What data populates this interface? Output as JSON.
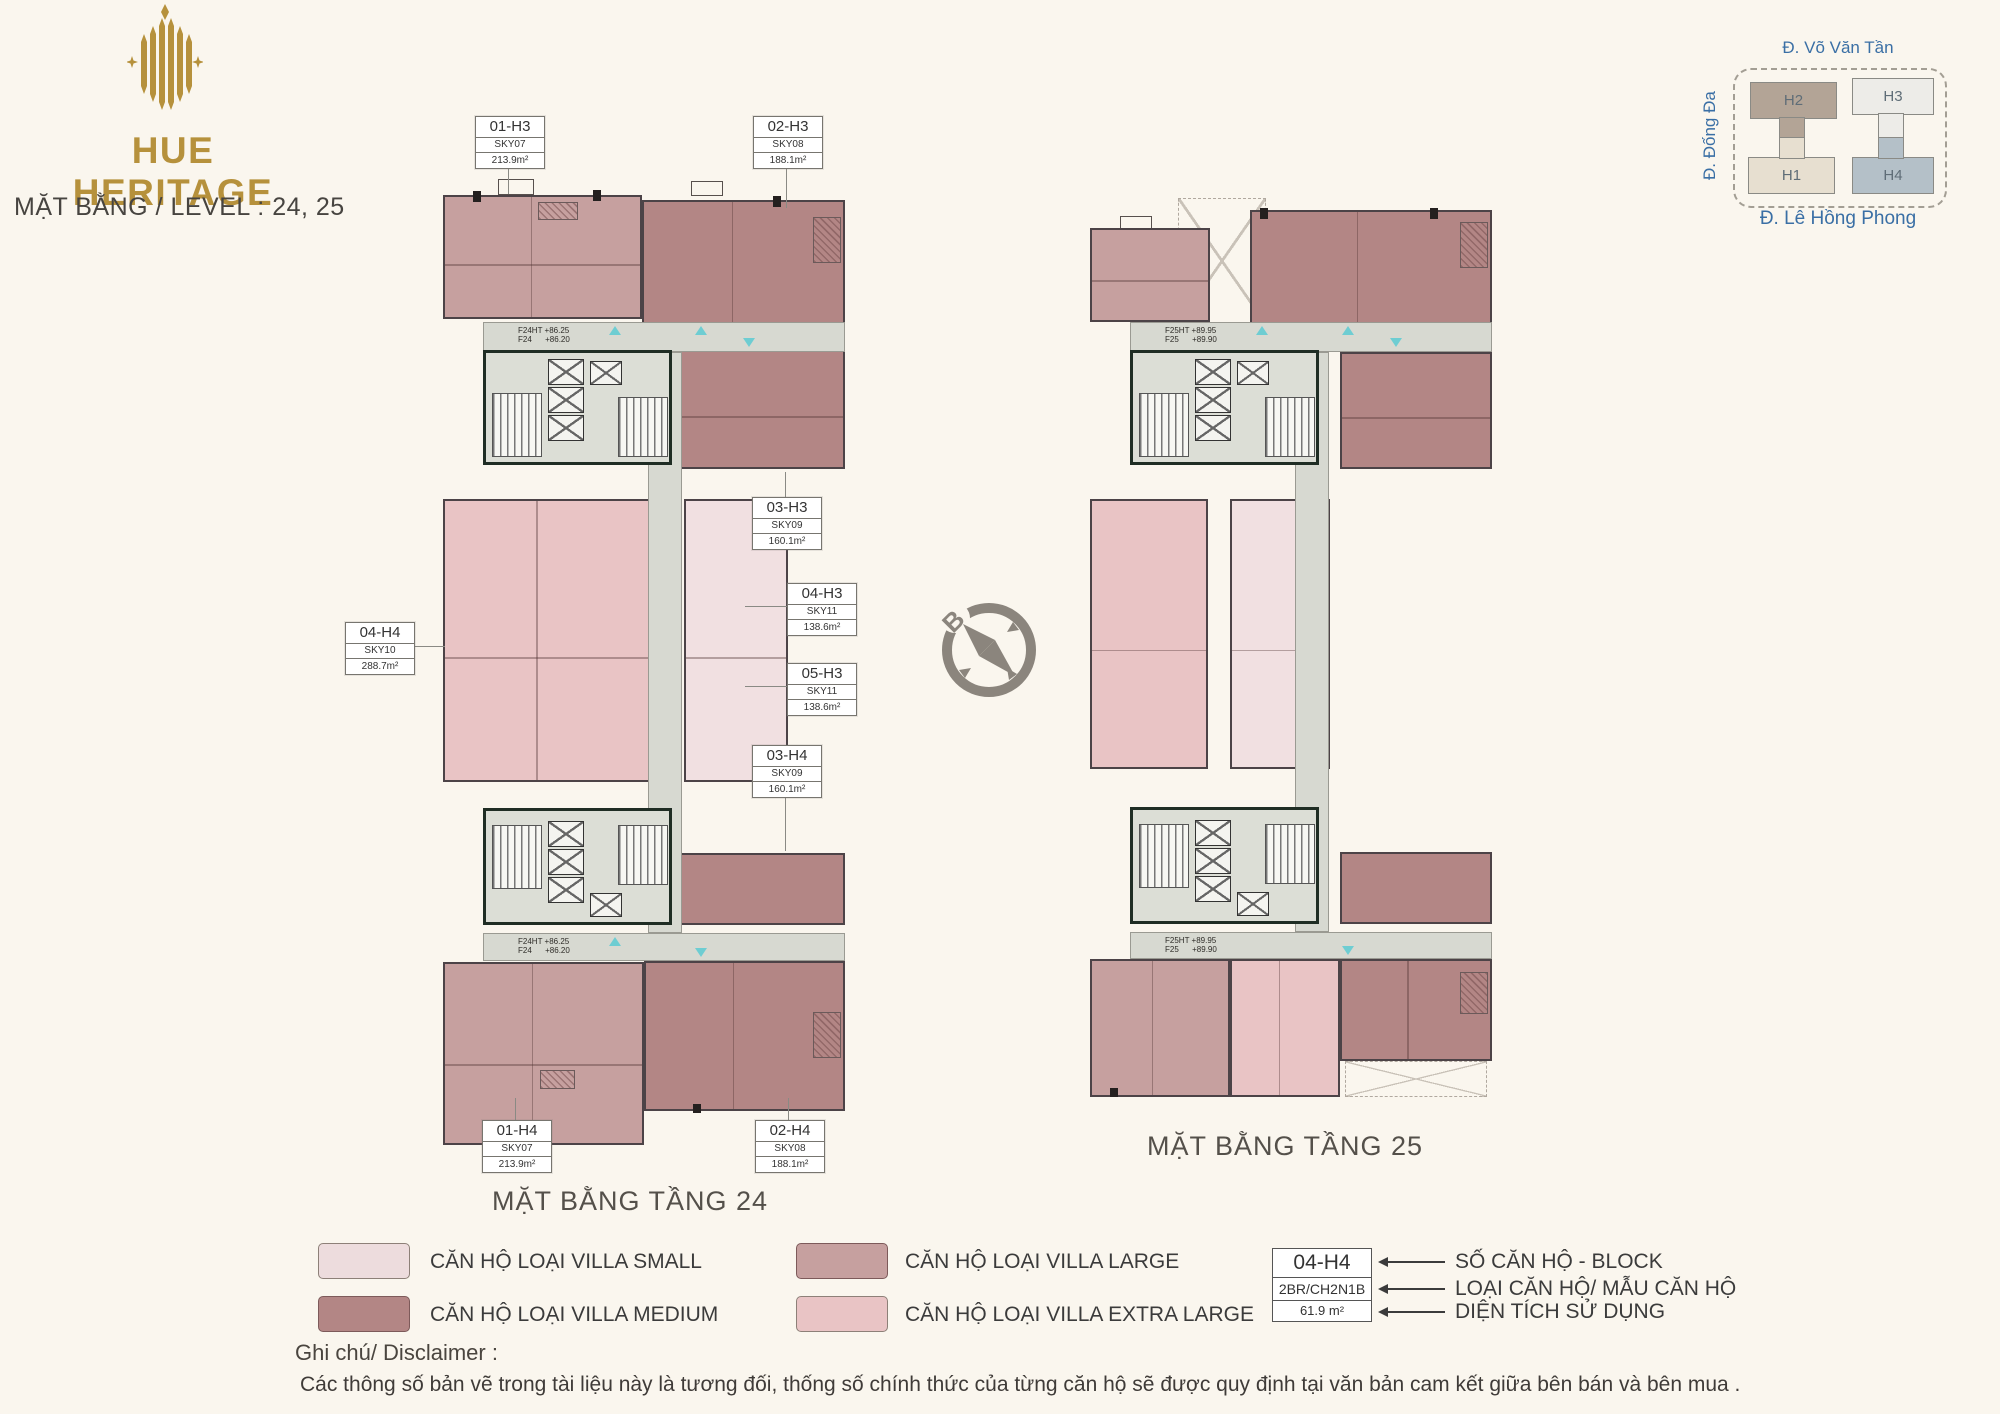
{
  "header": {
    "brand": "HUE HERITAGE",
    "subtitle": "MẶT BẰNG / LEVEL : 24, 25"
  },
  "site_map": {
    "street_top": "Đ. Võ Văn Tần",
    "street_left": "Đ. Đống Đa",
    "street_bottom": "Đ. Lê Hồng Phong",
    "blocks": [
      {
        "label": "H2",
        "color": "#b3a496"
      },
      {
        "label": "H3",
        "color": "#edece8"
      },
      {
        "label": "H1",
        "color": "#e7dfd0"
      },
      {
        "label": "H4",
        "color": "#b4c0c8"
      }
    ]
  },
  "compass": {
    "north": "B"
  },
  "plans": [
    {
      "caption": "MẶT BẰNG TẦNG 24",
      "level_note_top": "F24HT +86.25\nF24      +86.20",
      "level_note_bottom": "F24HT +86.25\nF24      +86.20",
      "labels": [
        {
          "code": "01-H3",
          "sky": "SKY07",
          "area": "213.9m²"
        },
        {
          "code": "02-H3",
          "sky": "SKY08",
          "area": "188.1m²"
        },
        {
          "code": "03-H3",
          "sky": "SKY09",
          "area": "160.1m²"
        },
        {
          "code": "04-H3",
          "sky": "SKY11",
          "area": "138.6m²"
        },
        {
          "code": "05-H3",
          "sky": "SKY11",
          "area": "138.6m²"
        },
        {
          "code": "03-H4",
          "sky": "SKY09",
          "area": "160.1m²"
        },
        {
          "code": "04-H4",
          "sky": "SKY10",
          "area": "288.7m²"
        },
        {
          "code": "01-H4",
          "sky": "SKY07",
          "area": "213.9m²"
        },
        {
          "code": "02-H4",
          "sky": "SKY08",
          "area": "188.1m²"
        }
      ]
    },
    {
      "caption": "MẶT BẰNG TẦNG 25",
      "level_note_top": "F25HT +89.95\nF25      +89.90",
      "level_note_bottom": "F25HT +89.95\nF25      +89.90",
      "labels": []
    }
  ],
  "legend": {
    "items": [
      {
        "label": "CĂN HỘ LOẠI VILLA SMALL",
        "color": "#eddcdd"
      },
      {
        "label": "CĂN HỘ LOẠI VILLA MEDIUM",
        "color": "#b38685"
      },
      {
        "label": "CĂN HỘ LOẠI VILLA LARGE",
        "color": "#c6a09f"
      },
      {
        "label": "CĂN HỘ LOẠI VILLA EXTRA LARGE",
        "color": "#e9c4c5"
      }
    ]
  },
  "key_example": {
    "code": "04-H4",
    "unit_type": "2BR/CH2N1B",
    "area": "61.9 m²",
    "pointers": [
      "SỐ CĂN HỘ - BLOCK",
      "LOẠI CĂN HỘ/ MẪU CĂN HỘ",
      "DIỆN TÍCH SỬ DỤNG"
    ]
  },
  "disclaimer": {
    "title": "Ghi chú/ Disclaimer :",
    "text": "Các thông số bản vẽ trong tài liệu này là tương đối, thống số chính thức của từng căn hộ sẽ được quy định tại văn bản cam kết giữa bên bán và bên mua ."
  }
}
